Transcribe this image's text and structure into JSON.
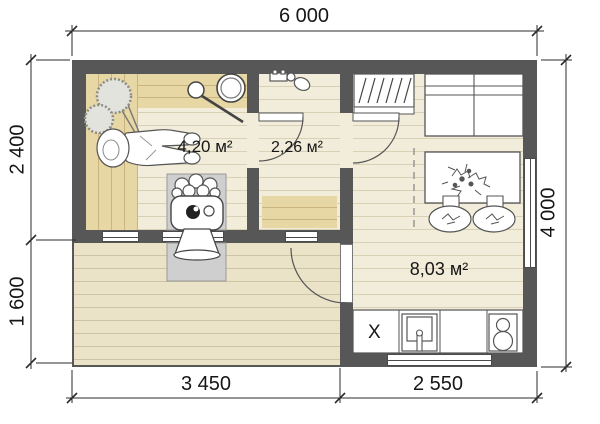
{
  "plan": {
    "dimensions": {
      "top": "6 000",
      "left_upper": "2 400",
      "left_lower": "1 600",
      "right": "4 000",
      "bottom_left": "3 450",
      "bottom_right": "2 550"
    },
    "rooms": {
      "sauna_area": "4,20 м²",
      "shower_area": "2,26 м²",
      "lounge_area": "8,03 м²"
    },
    "kitchen": {
      "fridge_label": "X"
    },
    "colors": {
      "wall": "#575757",
      "floor": "#f2edda",
      "bench": "#e7d7a4",
      "terrace": "#eae3c8",
      "stove_pad": "#cfcfcf"
    }
  }
}
